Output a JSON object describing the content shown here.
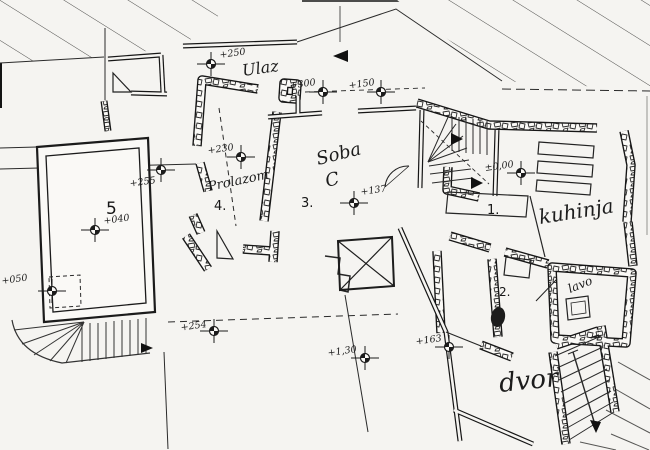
{
  "drawing": {
    "colors": {
      "paper": "#f5f4f1",
      "ink": "#1c1c1c",
      "hatch": "#555555",
      "stone_outline": "#2a2a2a"
    },
    "labels": [
      {
        "id": "room-5",
        "text": "5",
        "x": 106,
        "y": 214,
        "size": 17,
        "rot": 0,
        "font": "plain"
      },
      {
        "id": "ulaz",
        "text": "Ulaz",
        "x": 243,
        "y": 76,
        "size": 16,
        "rot": -8,
        "font": "hand"
      },
      {
        "id": "prolazom",
        "text": "Prolazom",
        "x": 209,
        "y": 191,
        "size": 13,
        "rot": -12,
        "font": "hand"
      },
      {
        "id": "room-4",
        "text": "4.",
        "x": 214,
        "y": 210,
        "size": 13,
        "rot": 0,
        "font": "plain"
      },
      {
        "id": "soba",
        "text": "Soba",
        "x": 318,
        "y": 165,
        "size": 18,
        "rot": -14,
        "font": "hand"
      },
      {
        "id": "soba-c",
        "text": "C",
        "x": 327,
        "y": 187,
        "size": 18,
        "rot": -14,
        "font": "hand"
      },
      {
        "id": "room-3",
        "text": "3.",
        "x": 301,
        "y": 207,
        "size": 13,
        "rot": 0,
        "font": "plain"
      },
      {
        "id": "room-1",
        "text": "1.",
        "x": 487,
        "y": 214,
        "size": 13,
        "rot": 0,
        "font": "plain"
      },
      {
        "id": "kuhinja",
        "text": "kuhinja",
        "x": 540,
        "y": 224,
        "size": 20,
        "rot": -9,
        "font": "hand"
      },
      {
        "id": "room-2",
        "text": "2.",
        "x": 499,
        "y": 296,
        "size": 12,
        "rot": 0,
        "font": "plain"
      },
      {
        "id": "lavo",
        "text": "lavo",
        "x": 570,
        "y": 293,
        "size": 12,
        "rot": -22,
        "font": "hand"
      },
      {
        "id": "dvor",
        "text": "dvor",
        "x": 500,
        "y": 392,
        "size": 26,
        "rot": -6,
        "font": "hand"
      }
    ],
    "elevation_markers": [
      {
        "label": "+250",
        "cx": 211,
        "cy": 64,
        "tx": 220,
        "ty": 58,
        "anchor": "start"
      },
      {
        "label": "+300",
        "cx": 323,
        "cy": 92,
        "tx": 316,
        "ty": 85,
        "anchor": "end"
      },
      {
        "label": "+150",
        "cx": 381,
        "cy": 92,
        "tx": 375,
        "ty": 85,
        "anchor": "end"
      },
      {
        "label": "+230",
        "cx": 241,
        "cy": 157,
        "tx": 234,
        "ty": 150,
        "anchor": "end"
      },
      {
        "label": "+137",
        "cx": 354,
        "cy": 203,
        "tx": 361,
        "ty": 195,
        "anchor": "start"
      },
      {
        "label": "±0,00",
        "cx": 521,
        "cy": 173,
        "tx": 514,
        "ty": 167,
        "anchor": "end"
      },
      {
        "label": "+255",
        "cx": 161,
        "cy": 170,
        "tx": 156,
        "ty": 183,
        "anchor": "end"
      },
      {
        "label": "+040",
        "cx": 95,
        "cy": 230,
        "tx": 104,
        "ty": 224,
        "anchor": "start"
      },
      {
        "label": "+050",
        "cx": 52,
        "cy": 291,
        "tx": 2,
        "ty": 284,
        "anchor": "start"
      },
      {
        "label": "+254",
        "cx": 214,
        "cy": 331,
        "tx": 207,
        "ty": 327,
        "anchor": "end"
      },
      {
        "label": "+163",
        "cx": 449,
        "cy": 347,
        "tx": 442,
        "ty": 341,
        "anchor": "end"
      },
      {
        "label": "+1,30",
        "cx": 365,
        "cy": 358,
        "tx": 357,
        "ty": 352,
        "anchor": "end"
      }
    ]
  }
}
